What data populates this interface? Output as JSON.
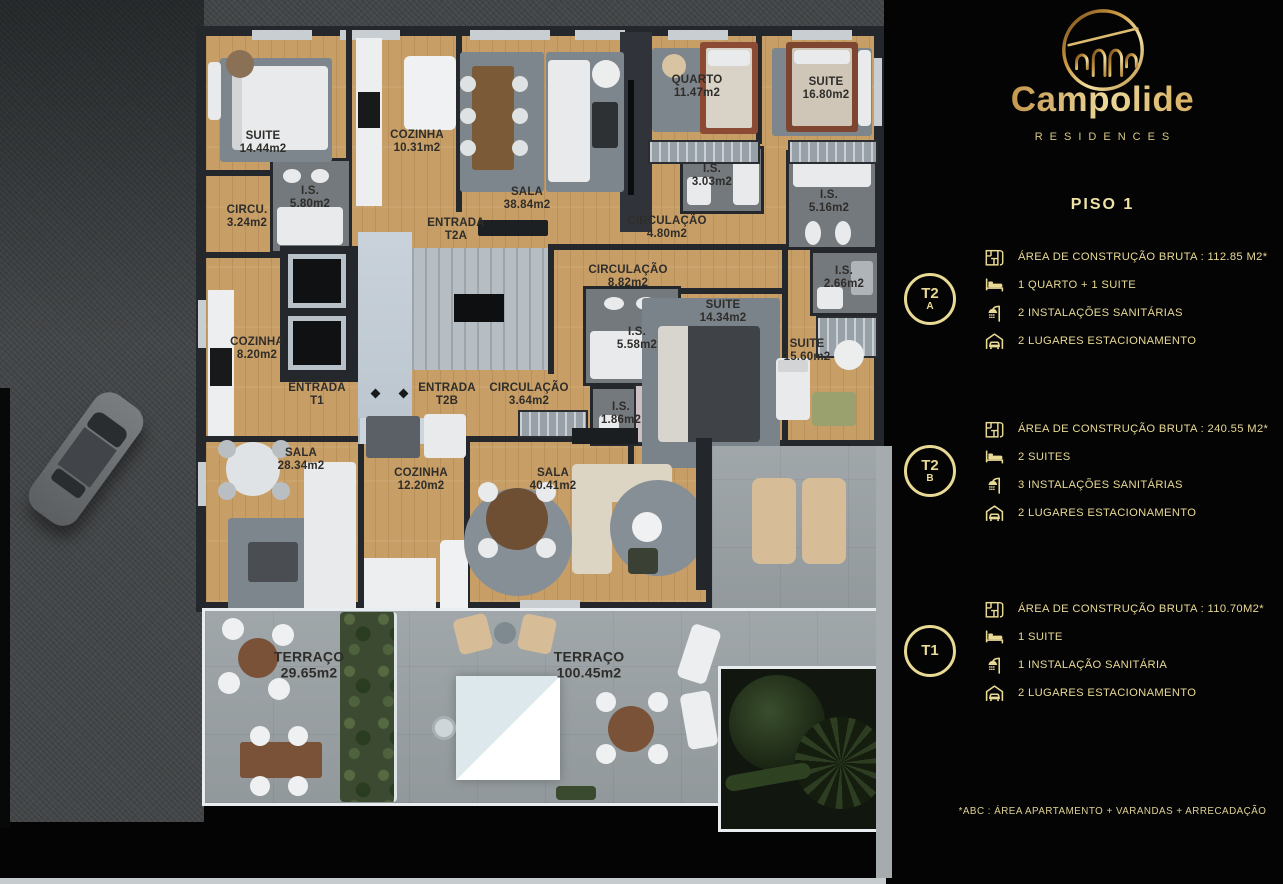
{
  "brand": {
    "name": "Campolide",
    "tagline": "RESIDENCES",
    "logo": "aqueduct-arches-logo"
  },
  "page": {
    "title": "PISO 1",
    "footnote": "*ABC :  ÁREA APARTAMENTO + VARANDAS + ARRECADAÇÃO"
  },
  "units": [
    {
      "id": "T2A",
      "badge_line1": "T2",
      "badge_line2": "A",
      "specs": [
        {
          "icon": "floorplan-icon",
          "text": "ÁREA DE CONSTRUÇÃO BRUTA :  112.85 M2*"
        },
        {
          "icon": "bed-icon",
          "text": "1 QUARTO + 1 SUITE"
        },
        {
          "icon": "shower-icon",
          "text": "2 INSTALAÇÕES SANITÁRIAS"
        },
        {
          "icon": "garage-icon",
          "text": "2 LUGARES ESTACIONAMENTO"
        }
      ]
    },
    {
      "id": "T2B",
      "badge_line1": "T2",
      "badge_line2": "B",
      "specs": [
        {
          "icon": "floorplan-icon",
          "text": "ÁREA DE CONSTRUÇÃO BRUTA :  240.55 M2*"
        },
        {
          "icon": "bed-icon",
          "text": "2 SUITES"
        },
        {
          "icon": "shower-icon",
          "text": "3 INSTALAÇÕES SANITÁRIAS"
        },
        {
          "icon": "garage-icon",
          "text": "2 LUGARES ESTACIONAMENTO"
        }
      ]
    },
    {
      "id": "T1",
      "badge_line1": "T1",
      "badge_line2": "",
      "specs": [
        {
          "icon": "floorplan-icon",
          "text": "ÁREA DE CONSTRUÇÃO BRUTA :  110.70M2*"
        },
        {
          "icon": "bed-icon",
          "text": "1 SUITE"
        },
        {
          "icon": "shower-icon",
          "text": "1 INSTALAÇÃO SANITÁRIA"
        },
        {
          "icon": "garage-icon",
          "text": "2 LUGARES ESTACIONAMENTO"
        }
      ]
    }
  ],
  "floorplan": {
    "floor": "PISO 1",
    "labels": [
      {
        "name": "SUITE",
        "area": "14.44m2"
      },
      {
        "name": "CIRCU.",
        "area": "3.24m2"
      },
      {
        "name": "I.S.",
        "area": "5.80m2"
      },
      {
        "name": "COZINHA",
        "area": "10.31m2"
      },
      {
        "name": "SALA",
        "area": "38.84m2"
      },
      {
        "name": "QUARTO",
        "area": "11.47m2"
      },
      {
        "name": "SUITE",
        "area": "16.80m2"
      },
      {
        "name": "I.S.",
        "area": "3.03m2"
      },
      {
        "name": "I.S.",
        "area": "5.16m2"
      },
      {
        "name": "CIRCULAÇÃO",
        "area": "4.80m2"
      },
      {
        "name": "ENTRADA",
        "area": "T2A"
      },
      {
        "name": "CIRCULAÇÃO",
        "area": "8.82m2"
      },
      {
        "name": "I.S.",
        "area": "2.66m2"
      },
      {
        "name": "SUITE",
        "area": "14.34m2"
      },
      {
        "name": "I.S.",
        "area": "5.58m2"
      },
      {
        "name": "SUITE",
        "area": "15.60m2"
      },
      {
        "name": "COZINHA",
        "area": "8.20m2"
      },
      {
        "name": "ENTRADA",
        "area": "T1"
      },
      {
        "name": "ENTRADA",
        "area": "T2B"
      },
      {
        "name": "CIRCULAÇÃO",
        "area": "3.64m2"
      },
      {
        "name": "I.S.",
        "area": "1.86m2"
      },
      {
        "name": "SALA",
        "area": "28.34m2"
      },
      {
        "name": "COZINHA",
        "area": "12.20m2"
      },
      {
        "name": "SALA",
        "area": "40.41m2"
      },
      {
        "name": "TERRAÇO",
        "area": "29.65m2"
      },
      {
        "name": "TERRAÇO",
        "area": "100.45m2"
      }
    ]
  },
  "colors": {
    "accent_gold": "#e8d995",
    "wood": "#c89e67",
    "wall": "#24272b",
    "terrace": "#9ba2a5",
    "street": "#45484a",
    "background": "#040404"
  }
}
